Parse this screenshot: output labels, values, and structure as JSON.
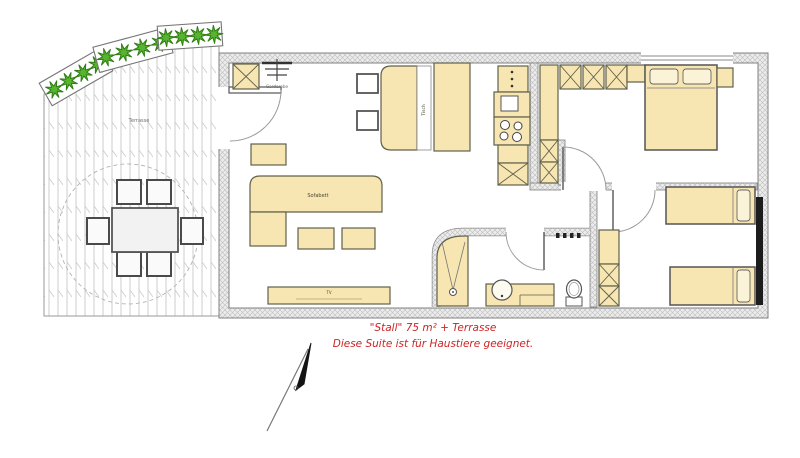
{
  "labels": {
    "terrace": "Terrasse",
    "coat_rack": "Garderobe",
    "sofa": "Sofabett",
    "dining_table": "Tisch",
    "tv": "TV"
  },
  "caption": {
    "line1": "\"Stall\" 75 m² + Terrasse",
    "line2": "Diese Suite ist für Haustiere geeignet."
  },
  "colors": {
    "furniture": "#f7e5b2",
    "bush_green": "#58b32e",
    "caption_red": "#cc2424",
    "wall_hatch": "#bdbdbd",
    "window_glass": "#1c1c1c"
  }
}
